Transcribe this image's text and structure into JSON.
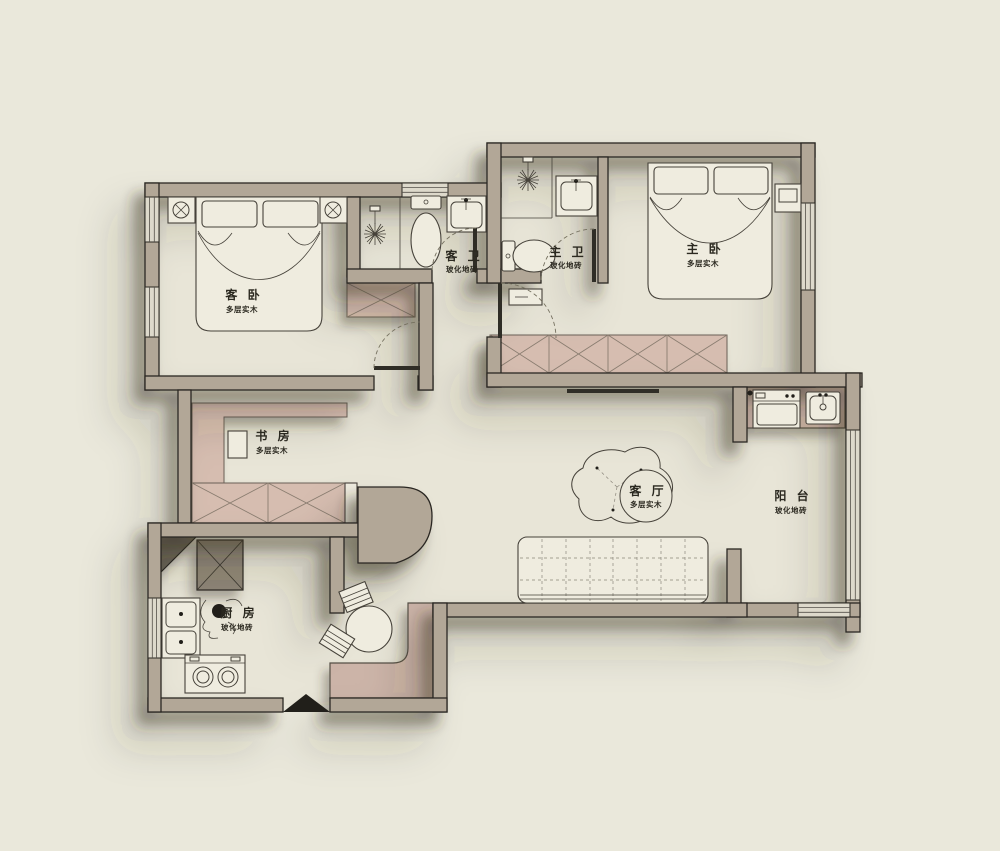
{
  "plan": {
    "type": "apartment-floor-plan",
    "rooms": [
      {
        "id": "guest-bedroom",
        "name": "客 卧",
        "material": "多层实木"
      },
      {
        "id": "guest-bathroom",
        "name": "客 卫",
        "material": "玻化地砖"
      },
      {
        "id": "master-bathroom",
        "name": "主 卫",
        "material": "玻化地砖"
      },
      {
        "id": "master-bedroom",
        "name": "主 卧",
        "material": "多层实木"
      },
      {
        "id": "study",
        "name": "书 房",
        "material": "多层实木"
      },
      {
        "id": "kitchen",
        "name": "厨 房",
        "material": "玻化地砖"
      },
      {
        "id": "living-room",
        "name": "客 厅",
        "material": "多层实木"
      },
      {
        "id": "balcony",
        "name": "阳 台",
        "material": "玻化地砖"
      }
    ],
    "colors": {
      "background": "#eae8db",
      "floor": "#e8e5d7",
      "wall": "#b2a797",
      "furniture_pink": "#d6bdb0",
      "outline": "#2a2822"
    }
  }
}
